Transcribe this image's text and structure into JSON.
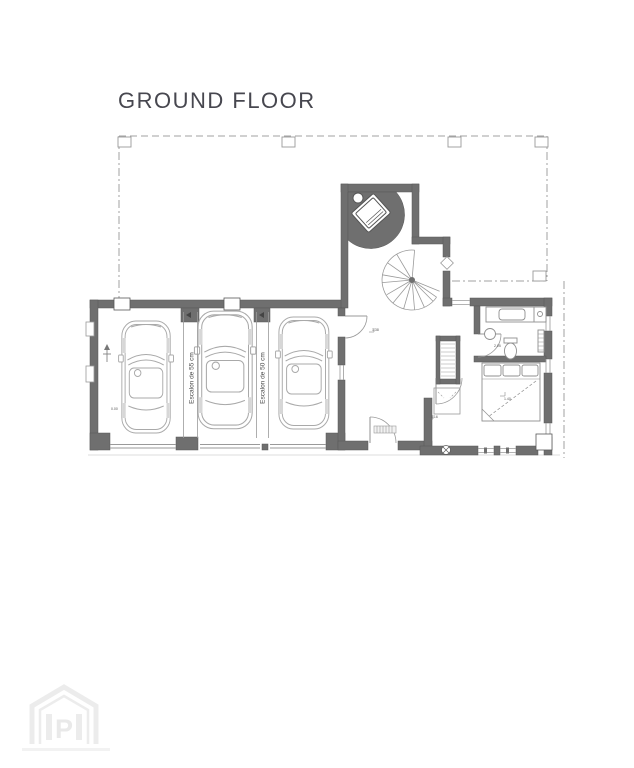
{
  "title": "GROUND FLOOR",
  "garage": {
    "step_label_1": "Escalon de 55 cm",
    "step_label_2": "Escalon de 50 cm"
  },
  "annotations": {
    "hall_upper": "1.38",
    "hall_lower": "1.16",
    "bedroom": "1.40",
    "bathroom": "2.05",
    "garage": "0.00"
  },
  "watermark": {
    "letter": "P"
  },
  "palette": {
    "wall": "#6f6f6f",
    "thin_line": "#9a9a9a",
    "car_line": "#a9a9a9",
    "boundary": "#a0a0a0",
    "title_text": "#47474f",
    "watermark": "#ececec"
  }
}
